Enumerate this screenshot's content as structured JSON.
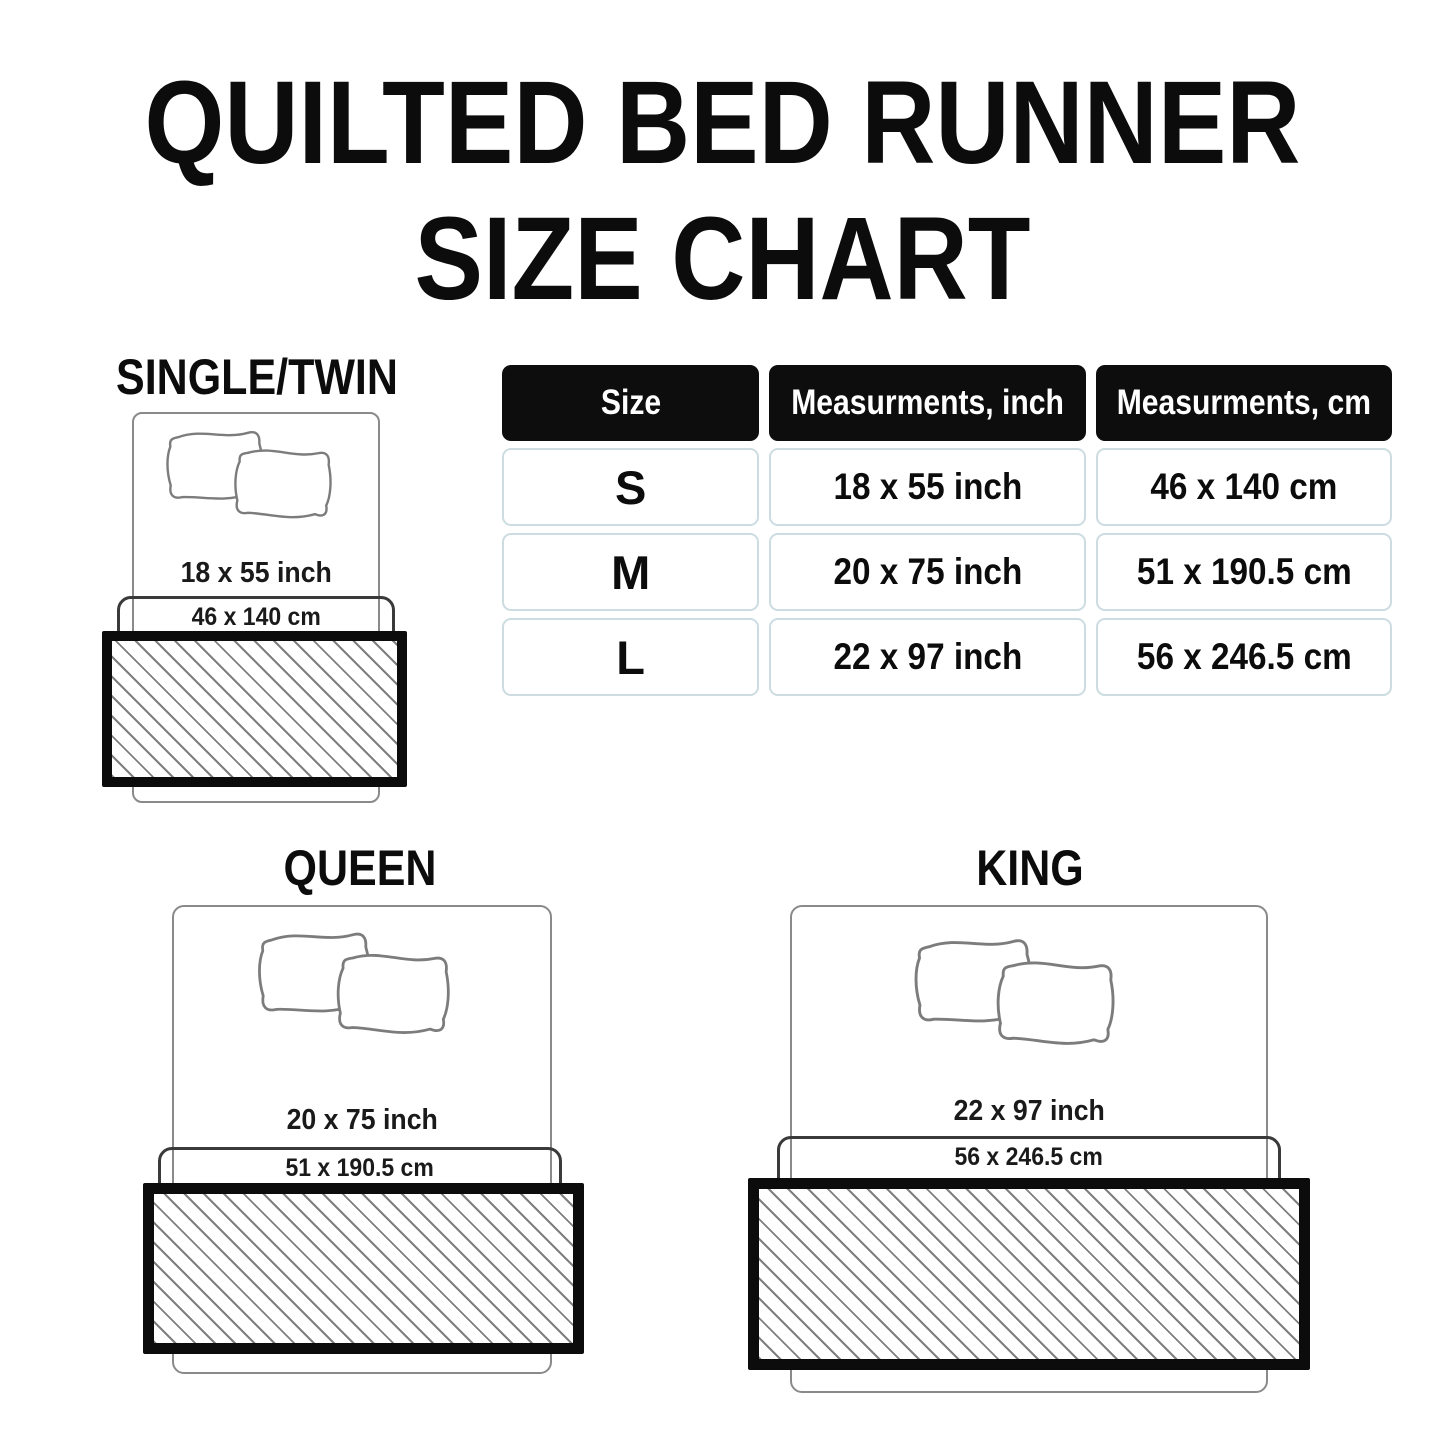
{
  "title": {
    "line1": "QUILTED BED RUNNER",
    "line2": "SIZE CHART"
  },
  "table": {
    "headers": [
      "Size",
      "Measurments, inch",
      "Measurments, cm"
    ],
    "rows": [
      {
        "size": "S",
        "inch": "18 x 55 inch",
        "cm": "46 x 140 cm"
      },
      {
        "size": "M",
        "inch": "20 x 75 inch",
        "cm": "51 x 190.5 cm"
      },
      {
        "size": "L",
        "inch": "22 x 97 inch",
        "cm": "56 x 246.5 cm"
      }
    ]
  },
  "diagrams": [
    {
      "name": "SINGLE/TWIN",
      "inch": "18 x 55 inch",
      "cm": "46 x 140 cm"
    },
    {
      "name": "QUEEN",
      "inch": "20 x 75 inch",
      "cm": "51 x 190.5 cm"
    },
    {
      "name": "KING",
      "inch": "22 x 97 inch",
      "cm": "56 x 246.5 cm"
    }
  ],
  "colors": {
    "ink": "#0c0c0c",
    "header_bg": "#0d0d0d",
    "header_text": "#ffffff",
    "table_cell_border": "#ccdce1",
    "bed_outline": "#8a8a8a",
    "sheet_outline": "#3a3a3a",
    "runner_hatch": "#7f7f7f"
  }
}
